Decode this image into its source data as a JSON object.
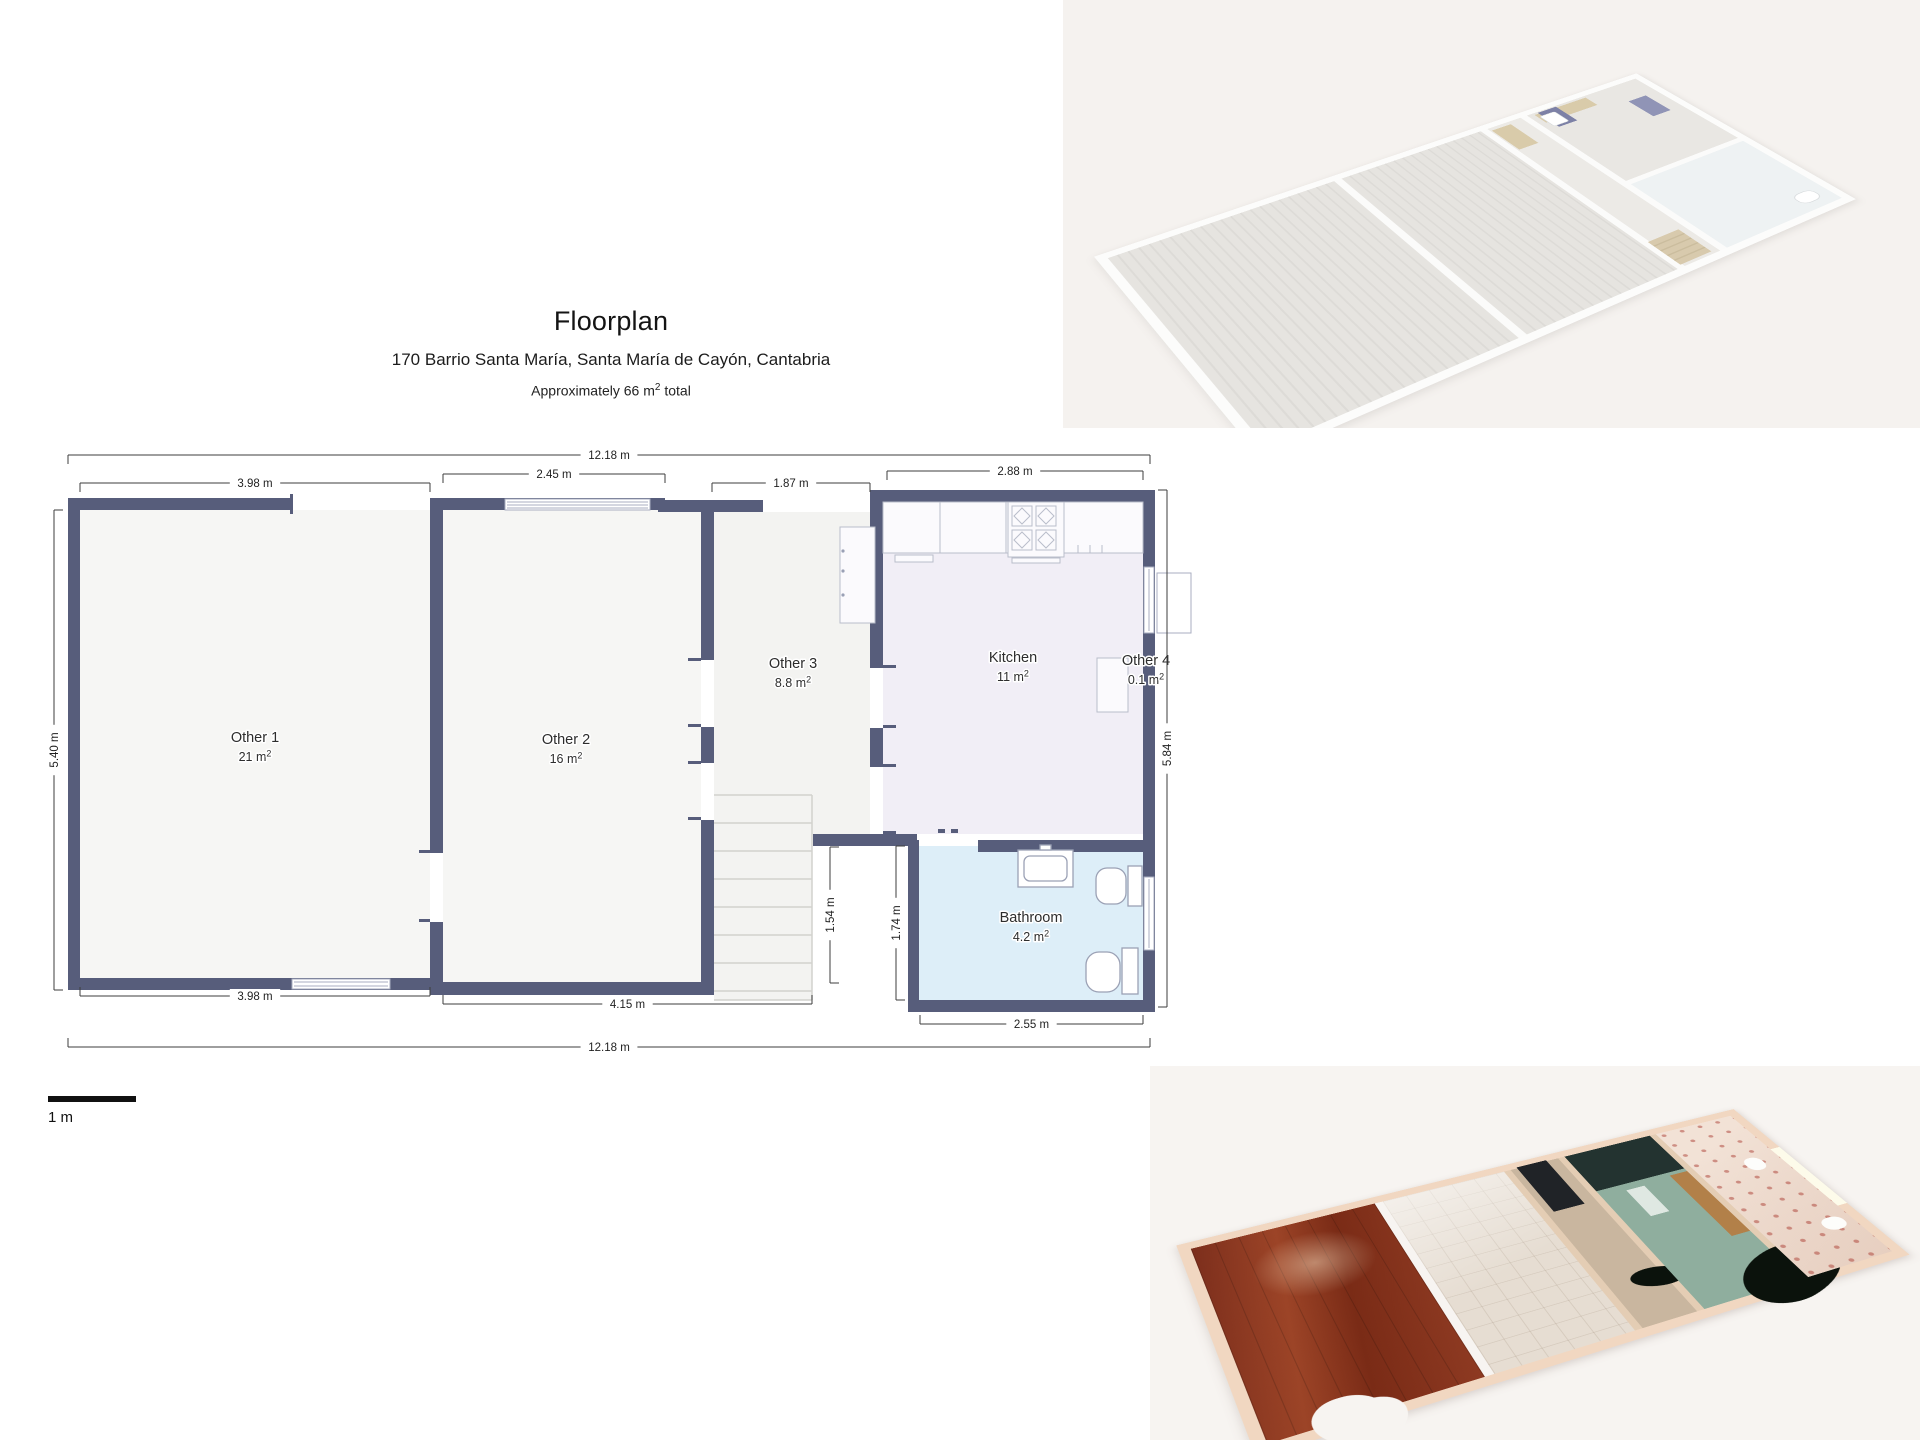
{
  "header": {
    "title": "Floorplan",
    "subtitle": "170 Barrio Santa María, Santa María de Cayón, Cantabria",
    "area_prefix": "Approximately 66 m",
    "area_sup": "2",
    "area_suffix": " total"
  },
  "floorplan": {
    "wall_color": "#575d7b",
    "room_fill": "#f6f6f4",
    "kitchen_fill": "#f1eef6",
    "bathroom_fill": "#ddeef8",
    "scale_label": "1 m",
    "rooms": [
      {
        "id": "other-1",
        "name": "Other 1",
        "area_m2": "21",
        "label_x": 255,
        "label_y": 742
      },
      {
        "id": "other-2",
        "name": "Other 2",
        "area_m2": "16",
        "label_x": 566,
        "label_y": 744
      },
      {
        "id": "other-3",
        "name": "Other 3",
        "area_m2": "8.8",
        "label_x": 793,
        "label_y": 668
      },
      {
        "id": "kitchen",
        "name": "Kitchen",
        "area_m2": "11",
        "label_x": 1013,
        "label_y": 662
      },
      {
        "id": "other-4",
        "name": "Other 4",
        "area_m2": "0.1",
        "label_x": 1146,
        "label_y": 665
      },
      {
        "id": "bathroom",
        "name": "Bathroom",
        "area_m2": "4.2",
        "label_x": 1031,
        "label_y": 922
      }
    ],
    "dimensions": [
      {
        "label": "12.18 m",
        "orient": "h",
        "x1": 68,
        "x2": 1150,
        "y": 455,
        "tick": "down"
      },
      {
        "label": "3.98 m",
        "orient": "h",
        "x1": 80,
        "x2": 430,
        "y": 483,
        "tick": "down"
      },
      {
        "label": "2.45 m",
        "orient": "h",
        "x1": 443,
        "x2": 665,
        "y": 474,
        "tick": "down"
      },
      {
        "label": "1.87 m",
        "orient": "h",
        "x1": 712,
        "x2": 870,
        "y": 483,
        "tick": "down"
      },
      {
        "label": "2.88 m",
        "orient": "h",
        "x1": 887,
        "x2": 1143,
        "y": 471,
        "tick": "down"
      },
      {
        "label": "3.98 m",
        "orient": "h",
        "x1": 80,
        "x2": 430,
        "y": 996,
        "tick": "up"
      },
      {
        "label": "4.15 m",
        "orient": "h",
        "x1": 443,
        "x2": 812,
        "y": 1004,
        "tick": "up"
      },
      {
        "label": "2.55 m",
        "orient": "h",
        "x1": 920,
        "x2": 1143,
        "y": 1024,
        "tick": "up"
      },
      {
        "label": "12.18 m",
        "orient": "h",
        "x1": 68,
        "x2": 1150,
        "y": 1047,
        "tick": "up"
      },
      {
        "label": "5.40 m",
        "orient": "v",
        "x": 54,
        "y1": 510,
        "y2": 990,
        "tick": "right"
      },
      {
        "label": "5.84 m",
        "orient": "v",
        "x": 1167,
        "y1": 490,
        "y2": 1007,
        "tick": "left"
      },
      {
        "label": "1.54 m",
        "orient": "v",
        "x": 830,
        "y1": 847,
        "y2": 983,
        "tick": "right"
      },
      {
        "label": "1.74 m",
        "orient": "v",
        "x": 896,
        "y1": 846,
        "y2": 1000,
        "tick": "right"
      }
    ]
  },
  "renders": {
    "white_model_bg": "#f5f2ef",
    "textured_model_bg": "#f7f4f1",
    "wood_floor_color": "#8a3322",
    "kitchen_wall_color": "#8fae9e"
  }
}
